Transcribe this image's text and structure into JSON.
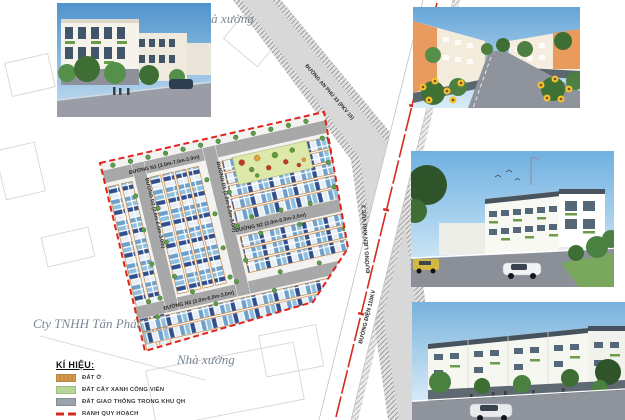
{
  "map": {
    "annotations": {
      "company": "Cty TNHH Tân Phát",
      "factory_top": "Nhà xưởng",
      "factory_bottom": "Nhà xưởng"
    },
    "roads": {
      "n1": "ĐƯỜNG N1 (3.0m-7.0m-3.0m)",
      "n2": "ĐƯỜNG N2 (3.0m-6.0m-3.0m)",
      "n3": "ĐƯỜNG N3 (3.0m-6.0m-3.0m)",
      "d1": "ĐƯỜNG D1 (2.0m-6.0m-3.0m)",
      "d2": "ĐƯỜNG D2 (2.0m-6.0m-3.0m)",
      "an_phu": "ĐƯỜNG AN PHÚ 33 (PKV 15)",
      "lien_khu_vuc": "ĐƯỜNG LIÊN KHU VỰC 2",
      "duong_dien": "ĐƯỜNG ĐIỆN 110KV"
    },
    "colors": {
      "boundary_red": "#e0241c",
      "power_line_red": "#d42a20",
      "road_gray": "#a8a8a8",
      "lot_light_blue": "#8fc0de",
      "lot_dark_blue": "#2f4f8e",
      "park_green": "#dde8a9",
      "frontage_orange": "#c87f35"
    }
  },
  "legend": {
    "title": "KÍ HIỆU:",
    "items": [
      {
        "label": "ĐẤT Ở",
        "color": "#d69a4e"
      },
      {
        "label": "ĐẤT CÂY XANH CÔNG VIÊN",
        "color": "#b9d69a"
      },
      {
        "label": "ĐẤT GIAO THÔNG TRONG KHU QH",
        "color": "#9aa2ab"
      },
      {
        "label": "RANH QUY HOẠCH",
        "color": "#d42a20"
      }
    ]
  }
}
